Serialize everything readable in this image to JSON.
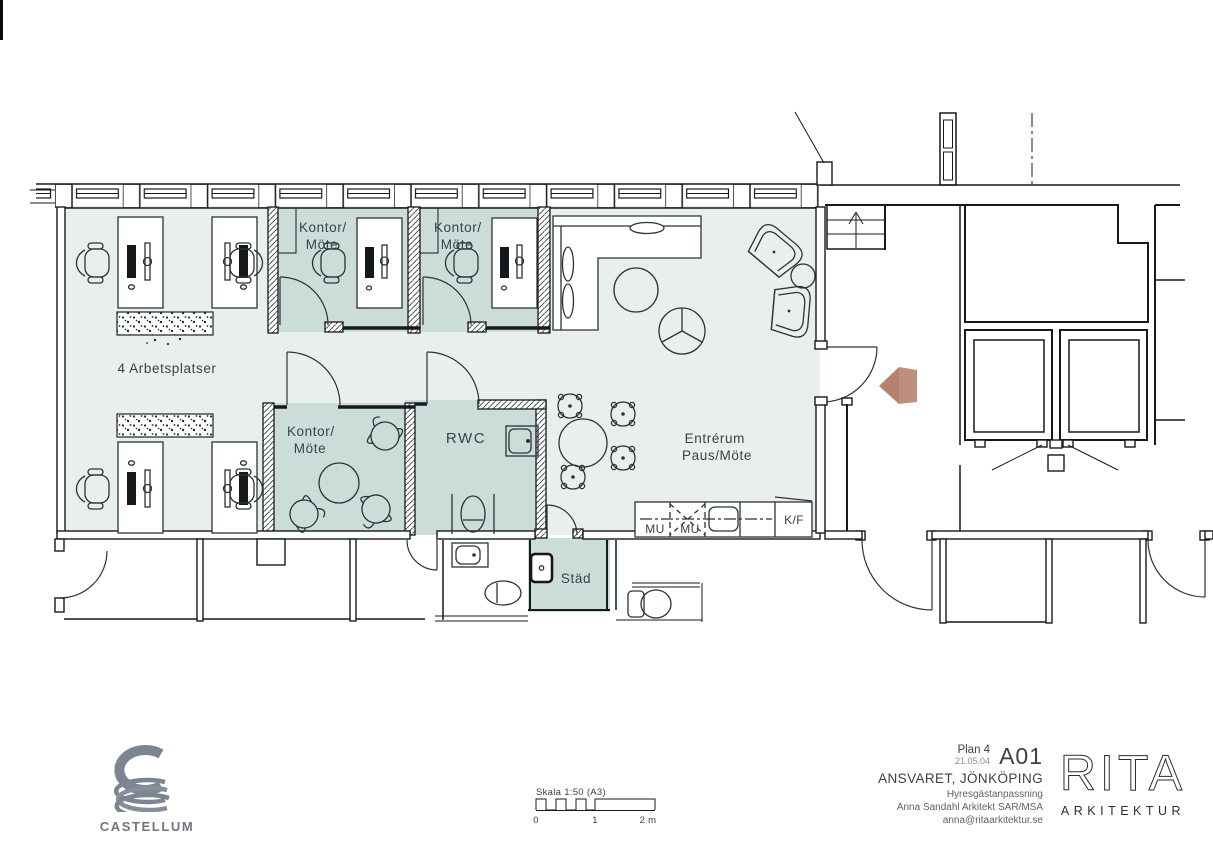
{
  "colors": {
    "open_fill": "#e8efed",
    "room_fill": "#cbdcd9",
    "arrow_accent": "#bd8b78",
    "castellum_gray": "#7c8591"
  },
  "rooms": {
    "kontor_top_1": {
      "label_line1": "Kontor/",
      "label_line2": "Möte"
    },
    "kontor_top_2": {
      "label_line1": "Kontor/",
      "label_line2": "Möte"
    },
    "kontor_mid": {
      "label_line1": "Kontor/",
      "label_line2": "Möte"
    },
    "open_office": {
      "label": "4 Arbetsplatser"
    },
    "rwc": {
      "label": "RWC"
    },
    "entre": {
      "label_line1": "Entrérum",
      "label_line2": "Paus/Möte"
    },
    "stad": {
      "label": "Städ"
    }
  },
  "kitchen": {
    "mu1": "MU",
    "mu2": "MU",
    "kf": "K/F"
  },
  "scalebar": {
    "title": "Skala 1:50 (A3)",
    "tick0": "0",
    "tick1": "1",
    "tick2": "2 m"
  },
  "titleblock": {
    "plan": "Plan 4",
    "date": "21.05.04",
    "sheet": "A01",
    "project": "ANSVARET, JÖNKÖPING",
    "subtitle": "Hyresgästanpassning",
    "architect": "Anna Sandahl Arkitekt SAR/MSA",
    "email": "anna@ritaarkitektur.se"
  },
  "logos": {
    "castellum": "CASTELLUM",
    "rita": "RITA",
    "rita_sub": "ARKITEKTUR"
  }
}
